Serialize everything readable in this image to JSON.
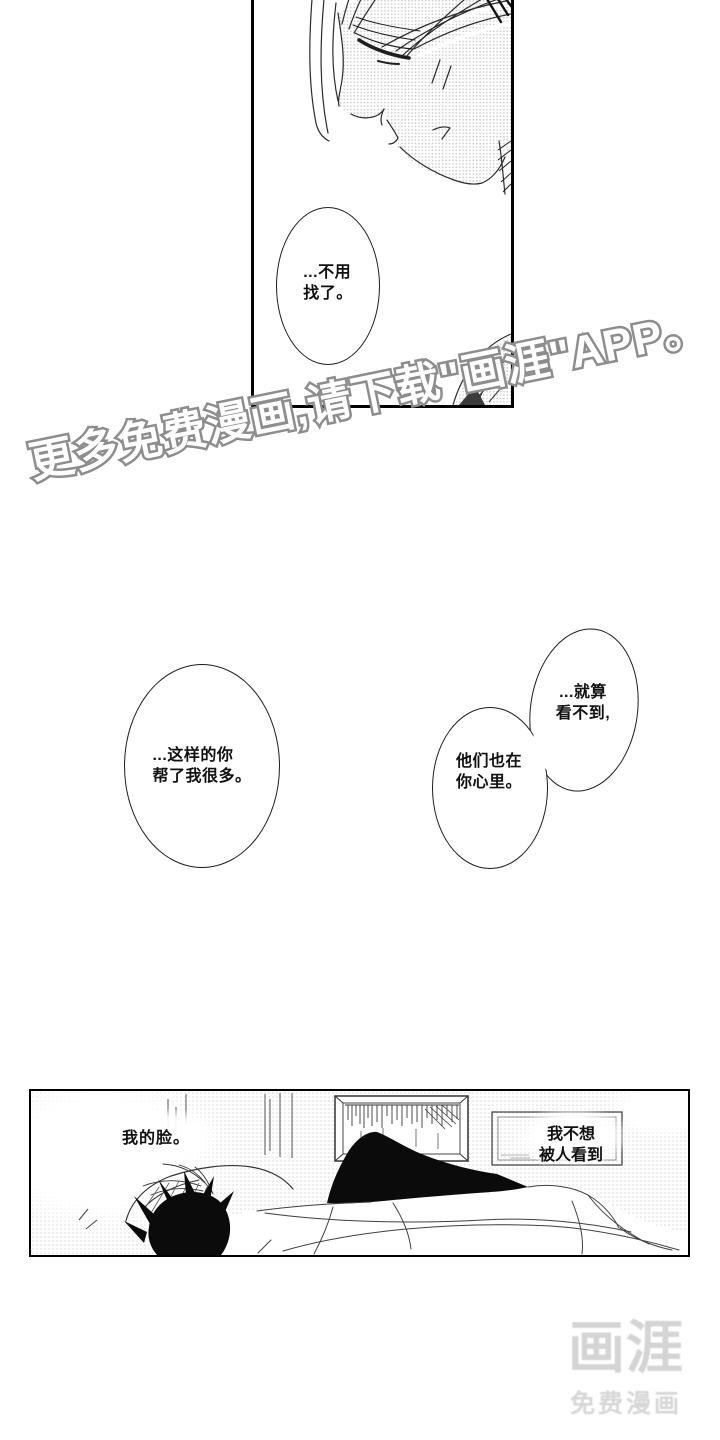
{
  "watermark": {
    "text": "更多免费漫画,请下载\"画涯\"APP。",
    "outline_color": "#8d8d8d",
    "fill_color": "#ffffff"
  },
  "panels": {
    "top": {
      "bubble": "...不用\n找了。"
    },
    "middle": {
      "bubble_left": "...这样的你\n帮了我很多。",
      "bubble_right_top": "...就算\n看不到,",
      "bubble_right_bottom": "他们也在\n你心里。"
    },
    "bottom": {
      "caption_left": "我的脸。",
      "caption_right": "我不想\n被人看到"
    }
  },
  "logo": {
    "title": "画涯",
    "subtitle": "免费漫画",
    "color": "#d4d4d4"
  },
  "colors": {
    "ink": "#000000",
    "halftone": "#c9c9c9",
    "paper": "#ffffff"
  }
}
